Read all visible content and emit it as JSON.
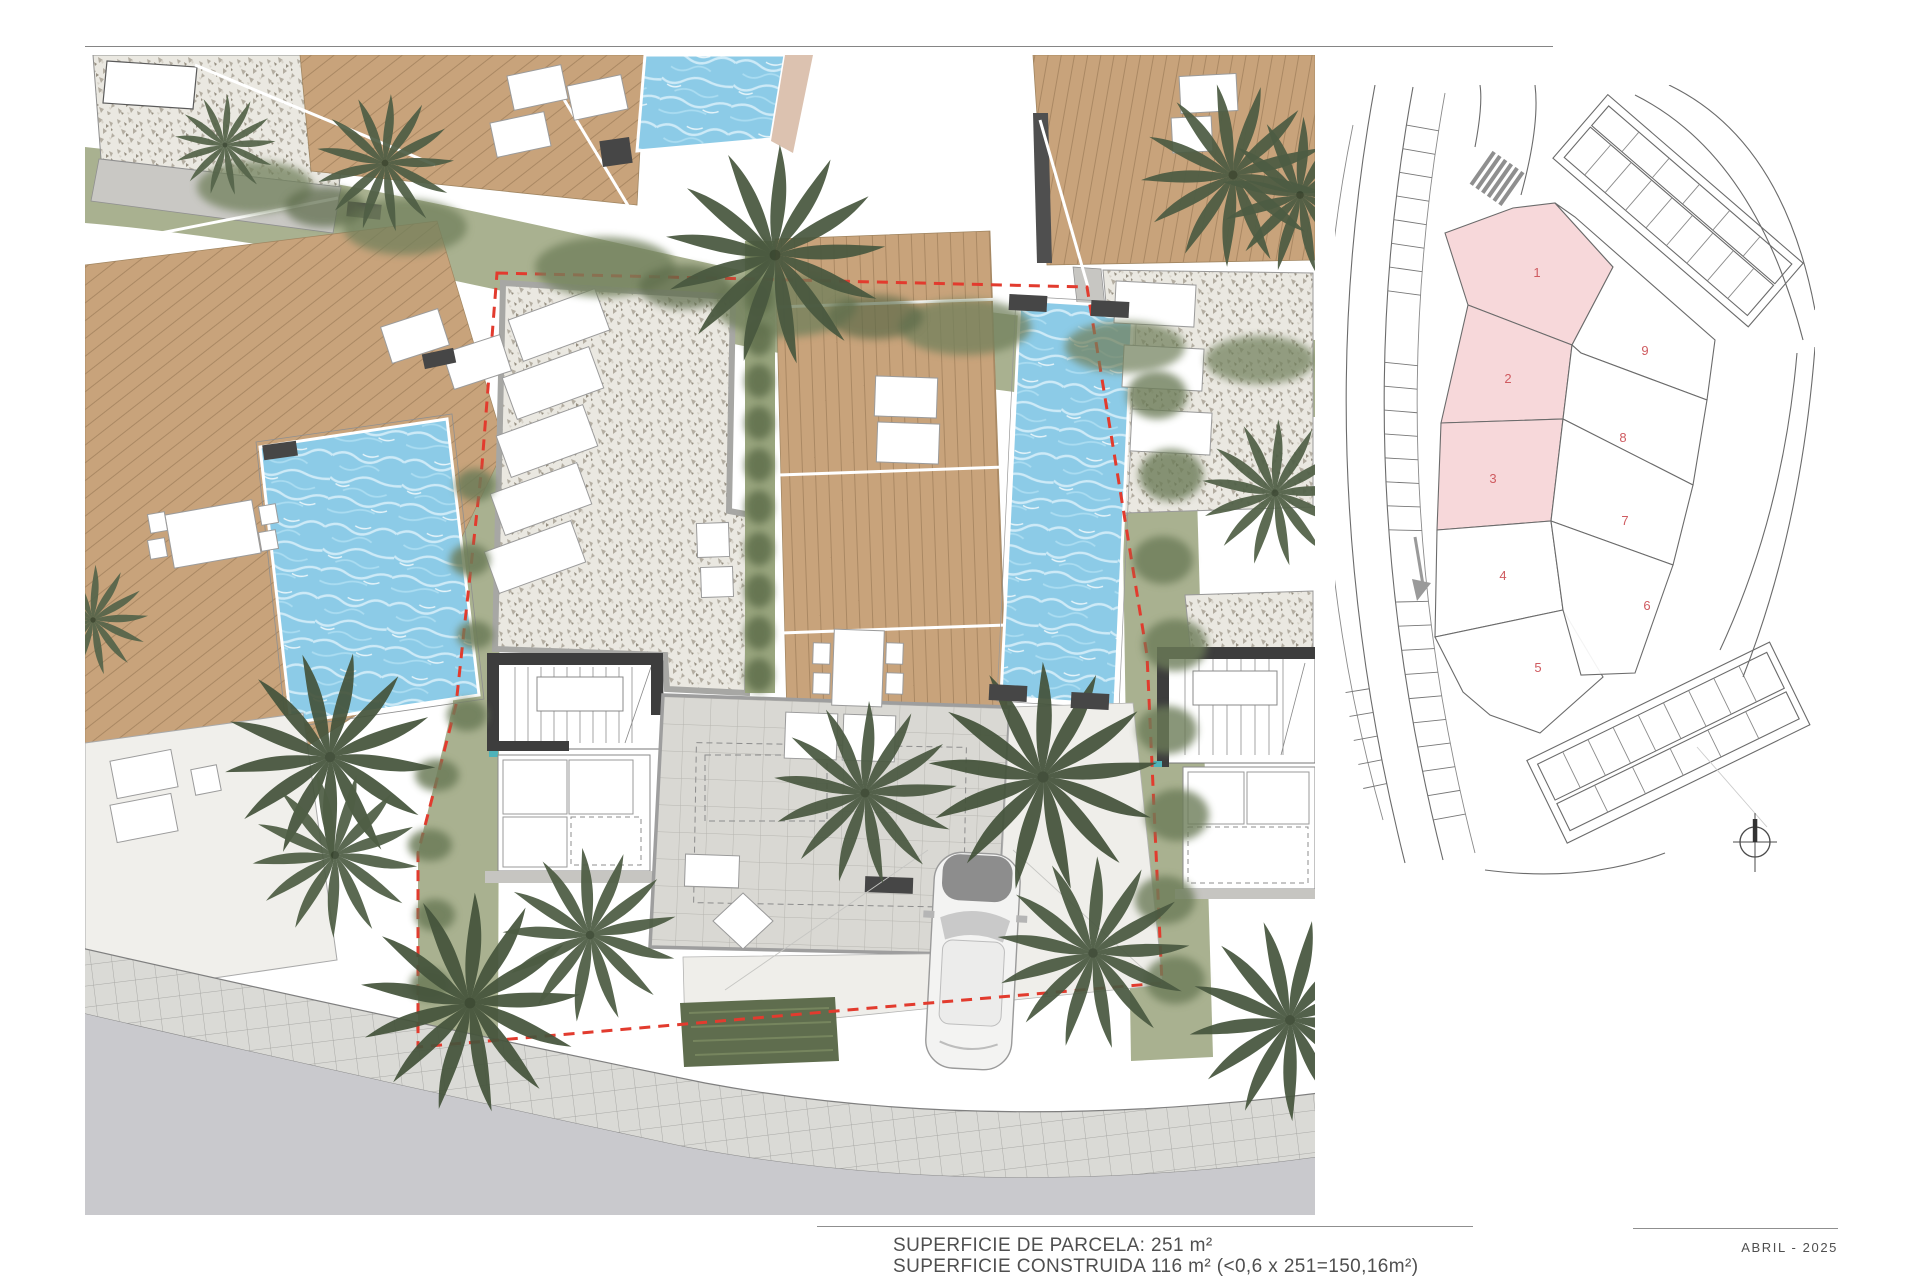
{
  "document": {
    "surface_parcel": "SUPERFICIE DE PARCELA: 251 m²",
    "surface_built": "SUPERFICIE CONSTRUIDA 116 m² (<0,6 x 251=150,16m²)",
    "date_label": "ABRIL - 2025"
  },
  "key_plan": {
    "plots": [
      {
        "label": "1",
        "highlighted": true
      },
      {
        "label": "2",
        "highlighted": true
      },
      {
        "label": "3",
        "highlighted": true
      },
      {
        "label": "4",
        "highlighted": false
      },
      {
        "label": "5",
        "highlighted": false
      },
      {
        "label": "6",
        "highlighted": false
      },
      {
        "label": "7",
        "highlighted": false
      },
      {
        "label": "8",
        "highlighted": false
      },
      {
        "label": "9",
        "highlighted": false
      }
    ]
  },
  "colors": {
    "highlight-pink": "#f7d8da",
    "plot-number": "#cf5b60",
    "boundary-red": "#e23b2e",
    "pool-blue": "#8ccbe7",
    "deck-brown": "#c8a37b",
    "vegetation": "#a9b190",
    "road-gray": "#c9c9cd",
    "text-gray": "#4f4f4f"
  }
}
